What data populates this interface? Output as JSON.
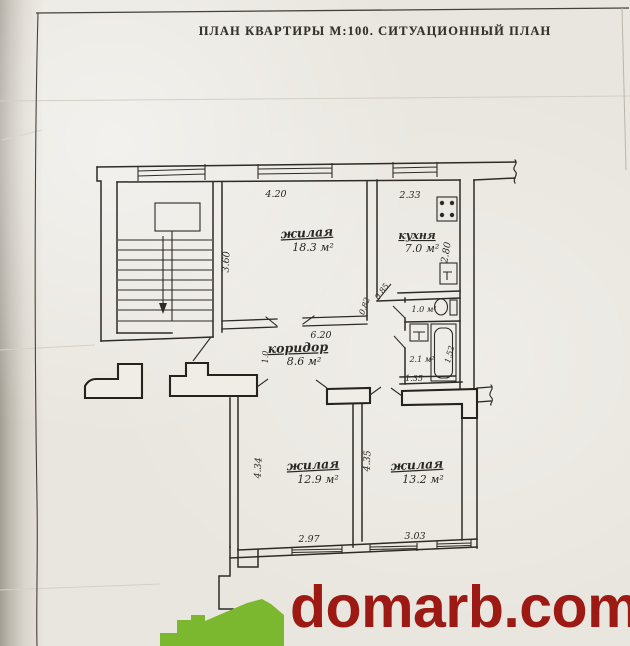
{
  "title": "ПЛАН КВАРТИРЫ М:100. СИТУАЦИОННЫЙ ПЛАН",
  "plan": {
    "rooms": {
      "living1": {
        "name": "жилая",
        "area": "18.3 м²"
      },
      "kitchen": {
        "name": "кухня",
        "area": "7.0 м²"
      },
      "corridor": {
        "name": "коридор",
        "area": "8.6 м²"
      },
      "wc": {
        "area": "1.0 м²"
      },
      "bath": {
        "area": "2.1 м²"
      },
      "living2": {
        "name": "жилая",
        "area": "12.9 м²"
      },
      "living3": {
        "name": "жилая",
        "area": "13.2 м²"
      }
    },
    "dimensions": {
      "top_room_width": "4.20",
      "kitchen_width": "2.33",
      "top_room_depth": "3.60",
      "kitchen_depth": "2.80",
      "corridor_length": "6.20",
      "corridor_door": "1.0",
      "door_a": "0.85",
      "door_b": "0.82",
      "bath_width": "1.35",
      "bath_depth": "1.52",
      "living2_depth": "4.34",
      "living3_depth": "4.35",
      "living2_width": "2.97",
      "living3_width": "3.03"
    }
  },
  "watermark": {
    "site": "domarb.com",
    "logo": "green-house",
    "text_color": "#9c1a13",
    "logo_color": "#7cb82f"
  },
  "colors": {
    "paper": "#e9e6df",
    "ink": "#2e2b26"
  }
}
